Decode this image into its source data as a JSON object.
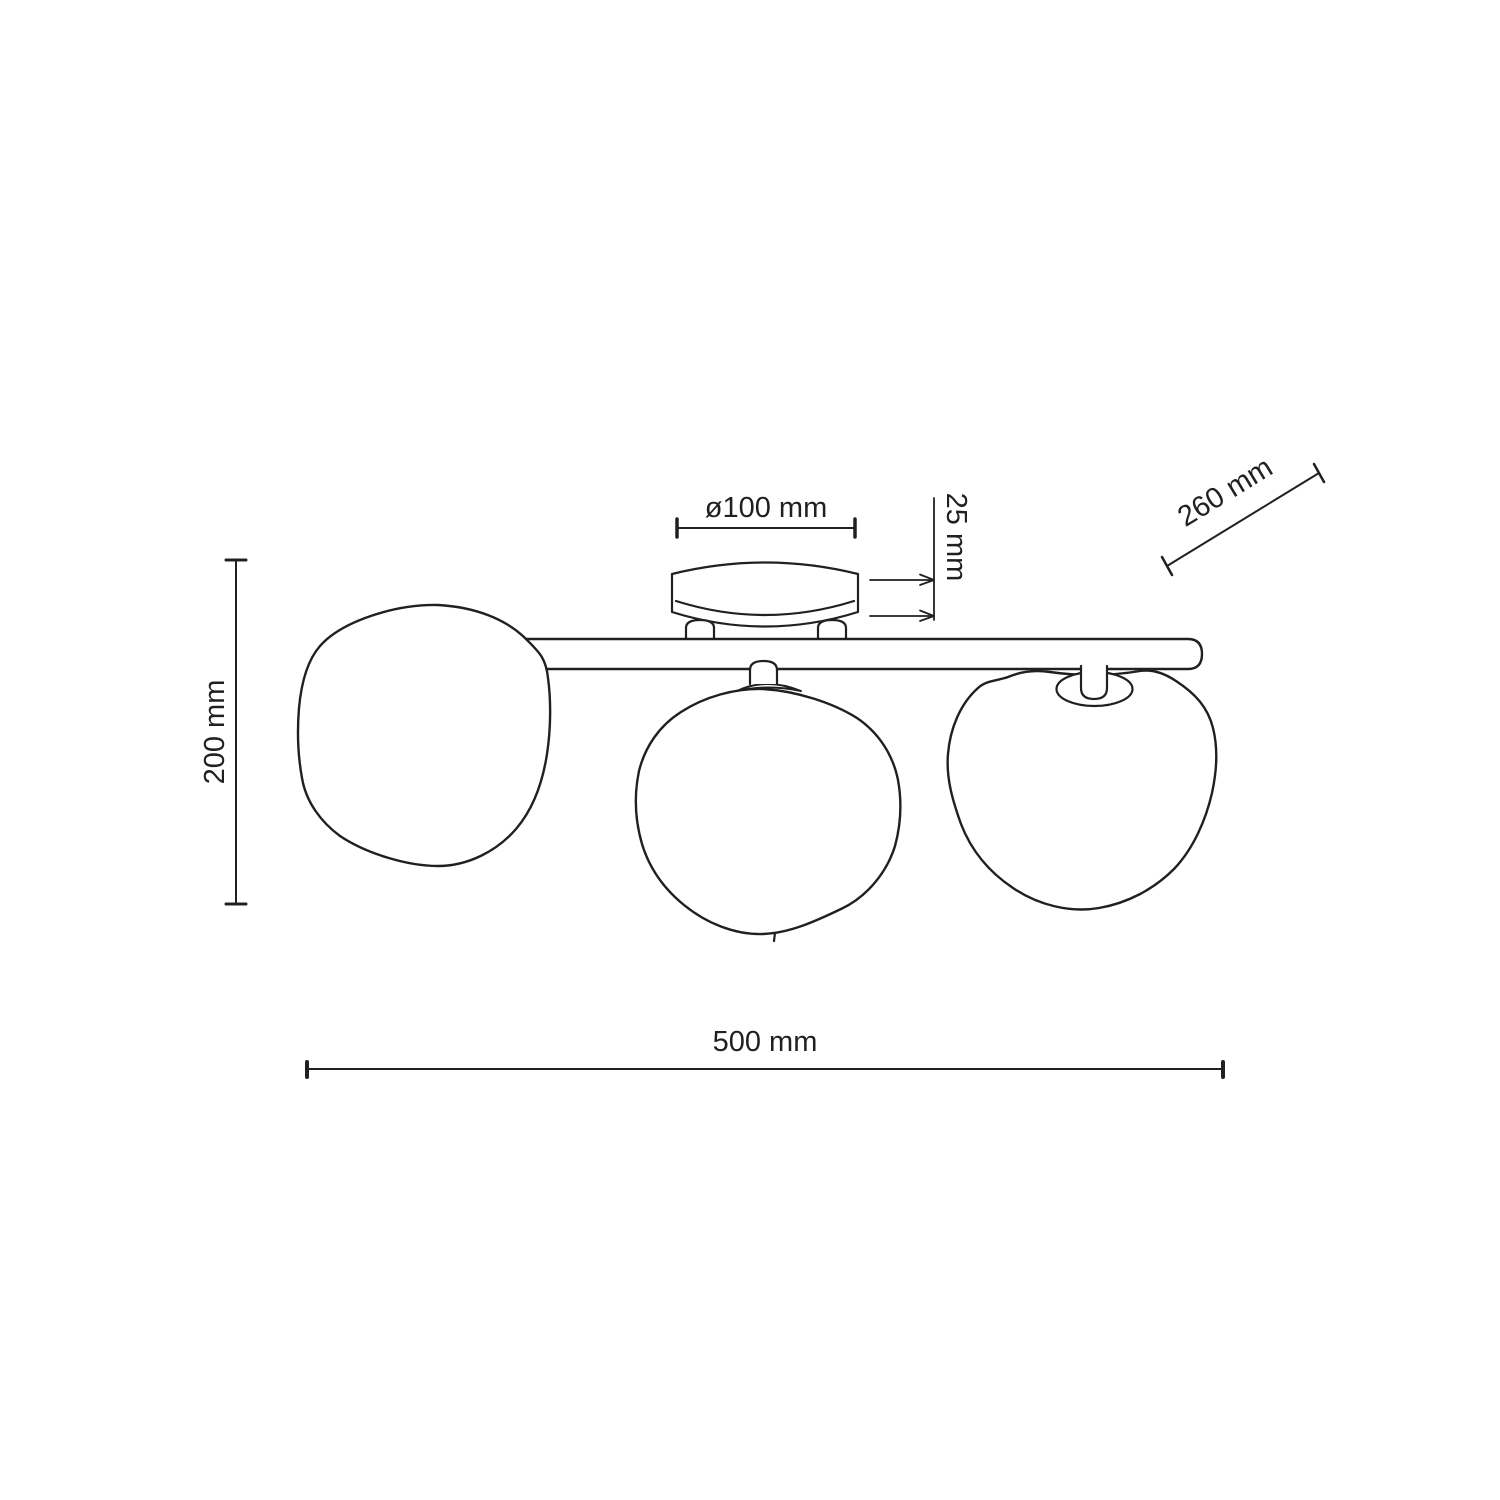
{
  "drawing": {
    "title": "Ceiling light fixture dimensional drawing",
    "style": "black line-art technical diagram on white",
    "colors": {
      "line": "#231f20",
      "background": "#ffffff"
    },
    "parts": [
      "ceiling canopy",
      "mounting bar",
      "left pebble glass shade",
      "middle pebble glass shade",
      "right pebble glass shade"
    ],
    "labels": {
      "canopy_diameter": "ø100 mm",
      "canopy_height": "25 mm",
      "shade_width": "260 mm",
      "fixture_height": "200 mm",
      "fixture_width": "500 mm"
    }
  }
}
